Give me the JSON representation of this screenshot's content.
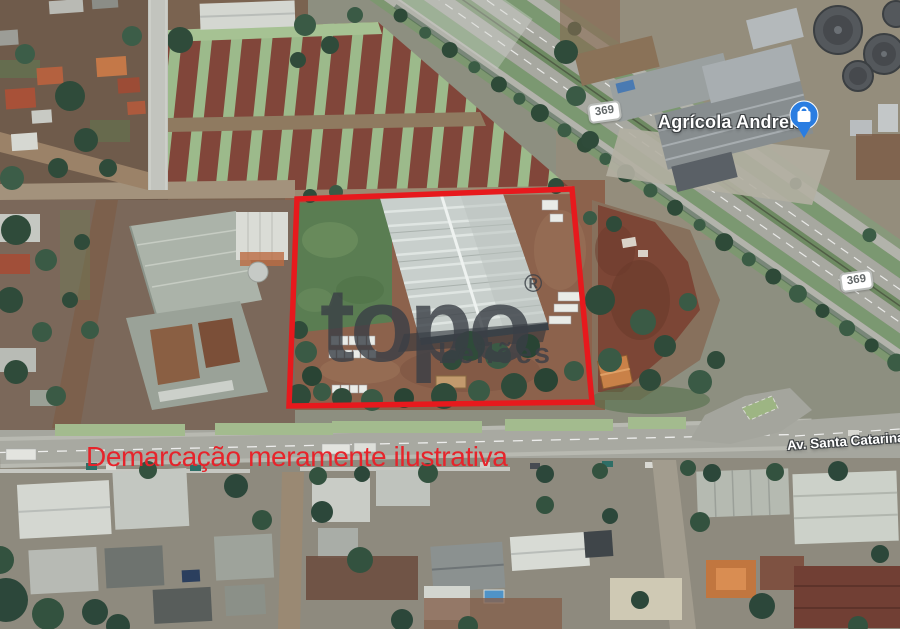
{
  "map": {
    "watermark": {
      "brand": "topo",
      "registered": "®",
      "subtitle": "Leilões"
    },
    "caption": "Demarcação meramente ilustrativa",
    "labels": {
      "place": "Agrícola Andreis",
      "shields": [
        "369",
        "369"
      ],
      "street": "Av. Santa Catarina"
    },
    "colors": {
      "demarcation_red": "#e7191d",
      "caption_red": "#e6242b",
      "watermark_gray": "#3a3f46",
      "pin_blue": "#2a7de1",
      "label_white": "#ffffff"
    },
    "demarcation_points": "297,199 572,189 592,402 289,406"
  }
}
